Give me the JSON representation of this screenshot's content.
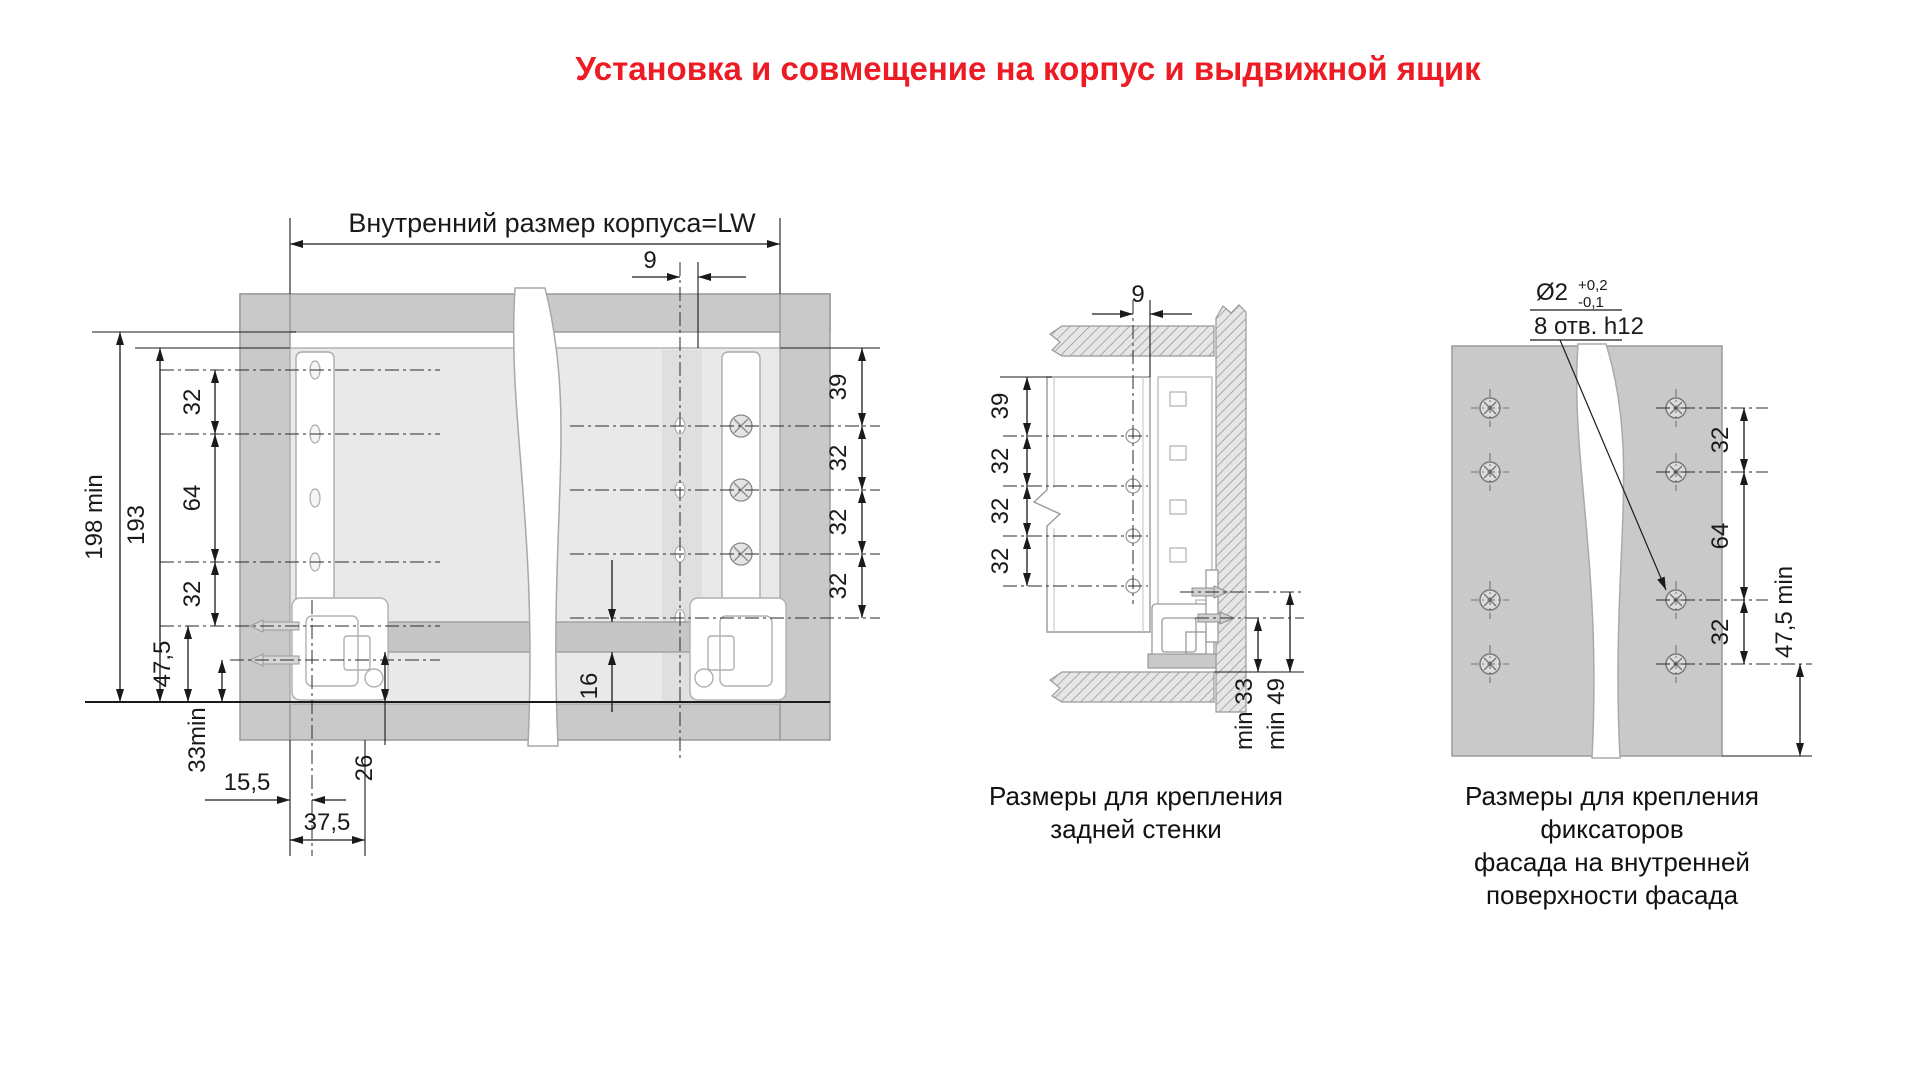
{
  "title": "Установка и совмещение на корпус и выдвижной ящик",
  "colors": {
    "accent_red": "#ed1c24",
    "panel_gray": "#c9c9c9",
    "drawer_gray": "#e9e9e9"
  },
  "left_drawing": {
    "top_label": "Внутренний размер корпуса=LW",
    "dim_top_offset": "9",
    "dim_height_min": "198 min",
    "dim_height": "193",
    "hole_chain": [
      "32",
      "64",
      "32"
    ],
    "dim_front": "47,5",
    "dim_bottom_min": "33min",
    "dim_side_inset": "15,5",
    "dim_front_inset": "37,5",
    "dim_rail": "26",
    "dim_gallery": "16",
    "side_chain": [
      "39",
      "32",
      "32",
      "32"
    ]
  },
  "middle_drawing": {
    "dim_top_offset": "9",
    "hole_chain": [
      "39",
      "32",
      "32",
      "32"
    ],
    "dim_min_33": "min 33",
    "dim_min_49": "min 49",
    "caption_line1": "Размеры для крепления",
    "caption_line2": "задней стенки"
  },
  "right_drawing": {
    "note_diameter": "Ø2",
    "note_tolerance_plus": "+0,2",
    "note_tolerance_minus": "-0,1",
    "note_holes": "8 отв. h12",
    "hole_chain": [
      "32",
      "64",
      "32"
    ],
    "dim_bottom_min": "47,5 min",
    "caption_line1": "Размеры для крепления фиксаторов",
    "caption_line2": "фасада на внутренней",
    "caption_line3": "поверхности фасада"
  }
}
